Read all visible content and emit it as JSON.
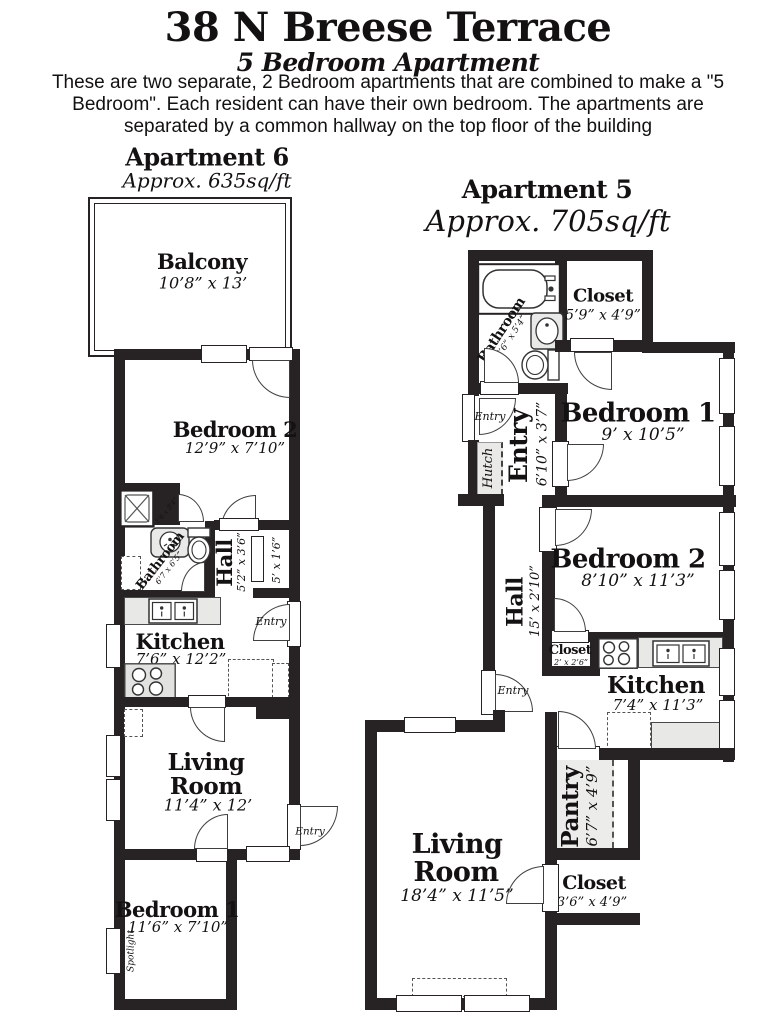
{
  "header": {
    "title": "38 N Breese Terrace",
    "subtitle": "5 Bedroom Apartment",
    "description": "These are two separate, 2 Bedroom apartments that are combined to make a \"5 Bedroom\". Each resident can have their own bedroom. The apartments are separated by a common hallway on the top floor of the building"
  },
  "apt6": {
    "title": "Apartment 6",
    "area": "Approx. 635sq/ft",
    "balcony": {
      "name": "Balcony",
      "dims": "10’8” x 13’"
    },
    "bedroom2": {
      "name": "Bedroom 2",
      "dims": "12’9” x 7’10”"
    },
    "bathroom": {
      "name": "Bathroom",
      "dims": "6’7 x 6’5”"
    },
    "bath_closet_dims": "1’6 x 3’4”",
    "hall": {
      "name": "Hall",
      "dims": "5’2” x 3’6”"
    },
    "closet_dims": "5’ x 1’6”",
    "kitchen": {
      "name": "Kitchen",
      "dims": "7’6” x 12’2”"
    },
    "entry_kitchen": "Entry",
    "living": {
      "line1": "Living",
      "line2": "Room",
      "dims": "11’4” x 12’"
    },
    "entry_living": "Entry",
    "bedroom1": {
      "name": "Bedroom 1",
      "dims": "11’6” x 7’10”"
    },
    "spotlight": "Spotlight"
  },
  "apt5": {
    "title": "Apartment 5",
    "area": "Approx. 705sq/ft",
    "bathroom": {
      "name": "Bathroom",
      "dims": "7’6” x 5’4”"
    },
    "closet_top": {
      "name": "Closet",
      "dims": "5’9” x 4’9”"
    },
    "entry_door": "Entry",
    "hutch": "Hutch",
    "entry_room": {
      "name": "Entry",
      "dims": "6’10” x 3’7”"
    },
    "bedroom1": {
      "name": "Bedroom 1",
      "dims": "9’ x 10’5”"
    },
    "bedroom2": {
      "name": "Bedroom 2",
      "dims": "8’10” x 11’3”"
    },
    "hall": {
      "name": "Hall",
      "dims": "15’ x 2’10”"
    },
    "closet_mid": {
      "name": "Closet",
      "dims": "2’ x 2’6”"
    },
    "kitchen": {
      "name": "Kitchen",
      "dims": "7’4” x 11’3”"
    },
    "hall_entry_door": "Entry",
    "pantry": {
      "name": "Pantry",
      "dims": "6’7” x 4’9”"
    },
    "closet_bottom": {
      "name": "Closet",
      "dims": "3’6” x 4’9”"
    },
    "living": {
      "line1": "Living",
      "line2": "Room",
      "dims": "18’4” x 11’5”"
    }
  }
}
